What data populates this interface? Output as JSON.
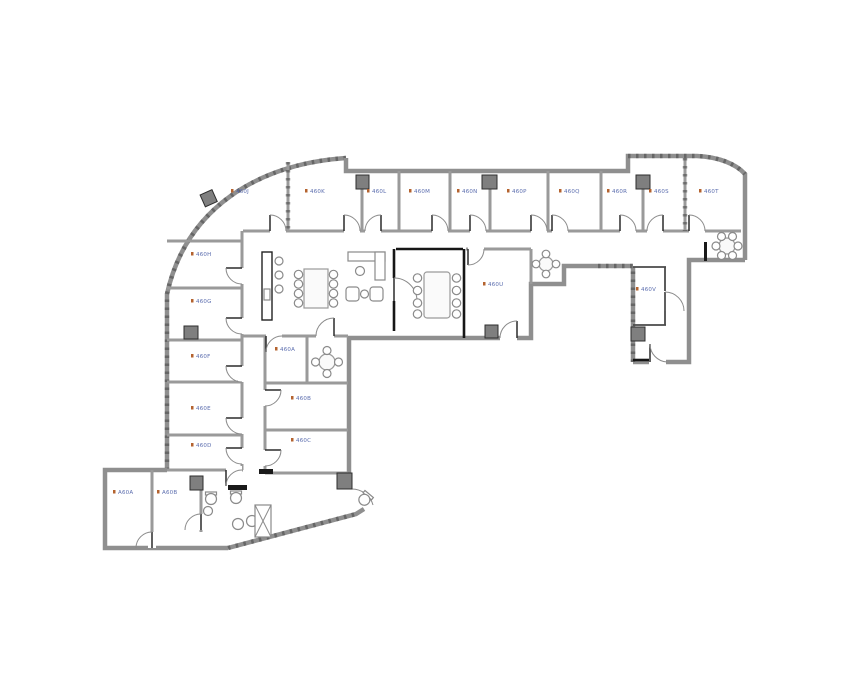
{
  "plan": {
    "type": "office-floor-plan",
    "background": "#ffffff"
  },
  "colors": {
    "wall_outer": "#8f8f8f",
    "wall_interior": "#9a9a9a",
    "wall_glass": "#161616",
    "column": "#7f7f7f",
    "label_text": "#5b6dae",
    "label_tick": "#b4632f"
  },
  "rooms": [
    {
      "label": "460J"
    },
    {
      "label": "460K"
    },
    {
      "label": "460L"
    },
    {
      "label": "460M"
    },
    {
      "label": "460N"
    },
    {
      "label": "460P"
    },
    {
      "label": "460Q"
    },
    {
      "label": "460R"
    },
    {
      "label": "460S"
    },
    {
      "label": "460T"
    },
    {
      "label": "460H"
    },
    {
      "label": "460G"
    },
    {
      "label": "460F"
    },
    {
      "label": "460E"
    },
    {
      "label": "460D"
    },
    {
      "label": "460A"
    },
    {
      "label": "460B"
    },
    {
      "label": "460C"
    },
    {
      "label": "460U"
    },
    {
      "label": "460V"
    },
    {
      "label": "A60A"
    },
    {
      "label": "A60B"
    }
  ]
}
